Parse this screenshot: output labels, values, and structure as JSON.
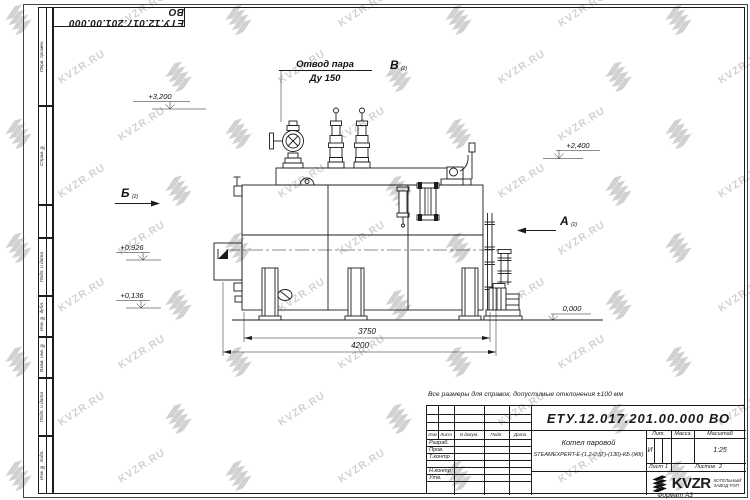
{
  "sheet": {
    "doc_number": "ЕТУ.12.017.201.00.000  ВО",
    "note": "Все размеры для справок, допустимые отклонения ±100 мм",
    "format_label": "Формат А3"
  },
  "watermark": {
    "text": "KVZR.RU"
  },
  "frame_columns": [
    "Перв. примен.",
    "Справ. №",
    "Подп. и дата",
    "Инв. № дубл.",
    "Взам. инв. №",
    "Подп. и дата",
    "Инв. № подл."
  ],
  "title_block": {
    "header_cols": [
      "Изм",
      "Лист",
      "N докум.",
      "Подп.",
      "Дата"
    ],
    "sign_rows": [
      "Разраб.",
      "Пров.",
      "Т.контр",
      "Н.контр",
      "Утв."
    ],
    "product_name_line1": "Котел паровой",
    "product_name_line2": "STEAMEXPERT-E-(1,2-0,5Г)-(130)-КБ (ЖК)",
    "lit_label": "Лит.",
    "lit_value": "И",
    "mass_label": "Масса",
    "scale_label": "Масштаб",
    "scale_value": "1:25",
    "sheet_label": "Лист",
    "sheet_value": "1",
    "sheets_label": "Листов",
    "sheets_value": "2",
    "company": "KVZR",
    "company_sub_line1": "КОТЕЛЬНЫЙ",
    "company_sub_line2": "ЗАВОД РЭП"
  },
  "annotations": {
    "steam_outlet_line1": "Отвод пара",
    "steam_outlet_line2": "Ду 150",
    "elev_3200": "+3,200",
    "elev_2400": "+2,400",
    "elev_0926": "+0,926",
    "elev_0136": "+0,136",
    "elev_0000": "0,000",
    "view_b": "Б",
    "view_a": "А",
    "view_v": "В",
    "view_sub": "(2)",
    "dim_3750": "3750",
    "dim_4200": "4200"
  }
}
